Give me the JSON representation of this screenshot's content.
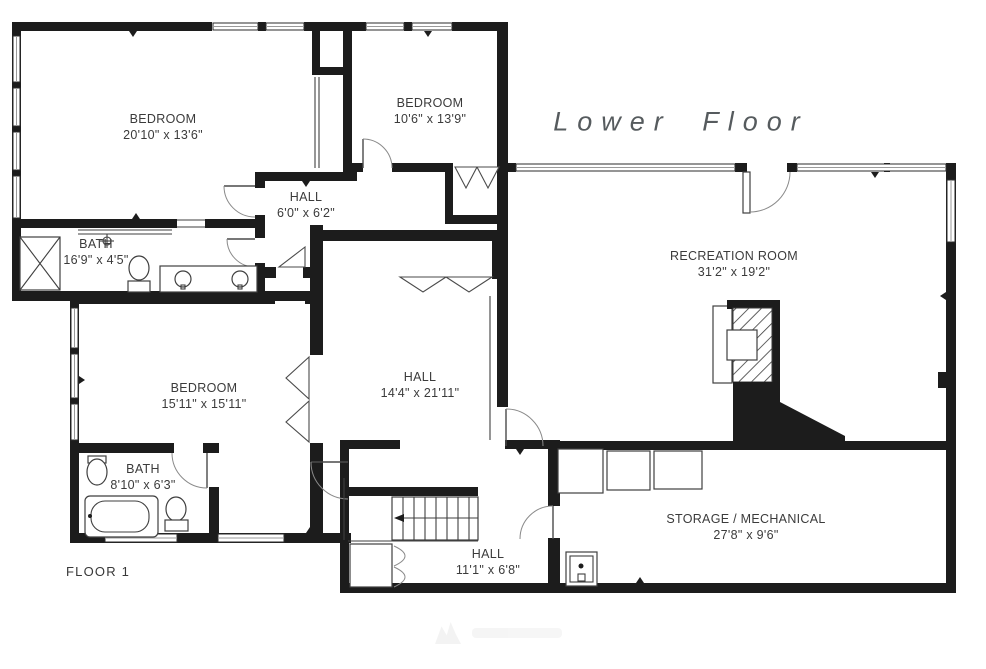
{
  "title": "Lower Floor",
  "floor_label": "FLOOR 1",
  "rooms": [
    {
      "name": "BEDROOM",
      "dims": "20'10\" x 13'6\""
    },
    {
      "name": "BEDROOM",
      "dims": "10'6\" x 13'9\""
    },
    {
      "name": "HALL",
      "dims": "6'0\" x 6'2\""
    },
    {
      "name": "BATH",
      "dims": "16'9\" x 4'5\""
    },
    {
      "name": "RECREATION ROOM",
      "dims": "31'2\" x 19'2\""
    },
    {
      "name": "BEDROOM",
      "dims": "15'11\" x 15'11\""
    },
    {
      "name": "HALL",
      "dims": "14'4\" x 21'11\""
    },
    {
      "name": "BATH",
      "dims": "8'10\" x 6'3\""
    },
    {
      "name": "HALL",
      "dims": "11'1\" x 6'8\""
    },
    {
      "name": "STORAGE / MECHANICAL",
      "dims": "27'8\" x 9'6\""
    }
  ],
  "colors": {
    "wall": "#1c1c1c",
    "label_text": "#3b3b3b",
    "title_text": "#565b5e",
    "background": "#ffffff"
  }
}
